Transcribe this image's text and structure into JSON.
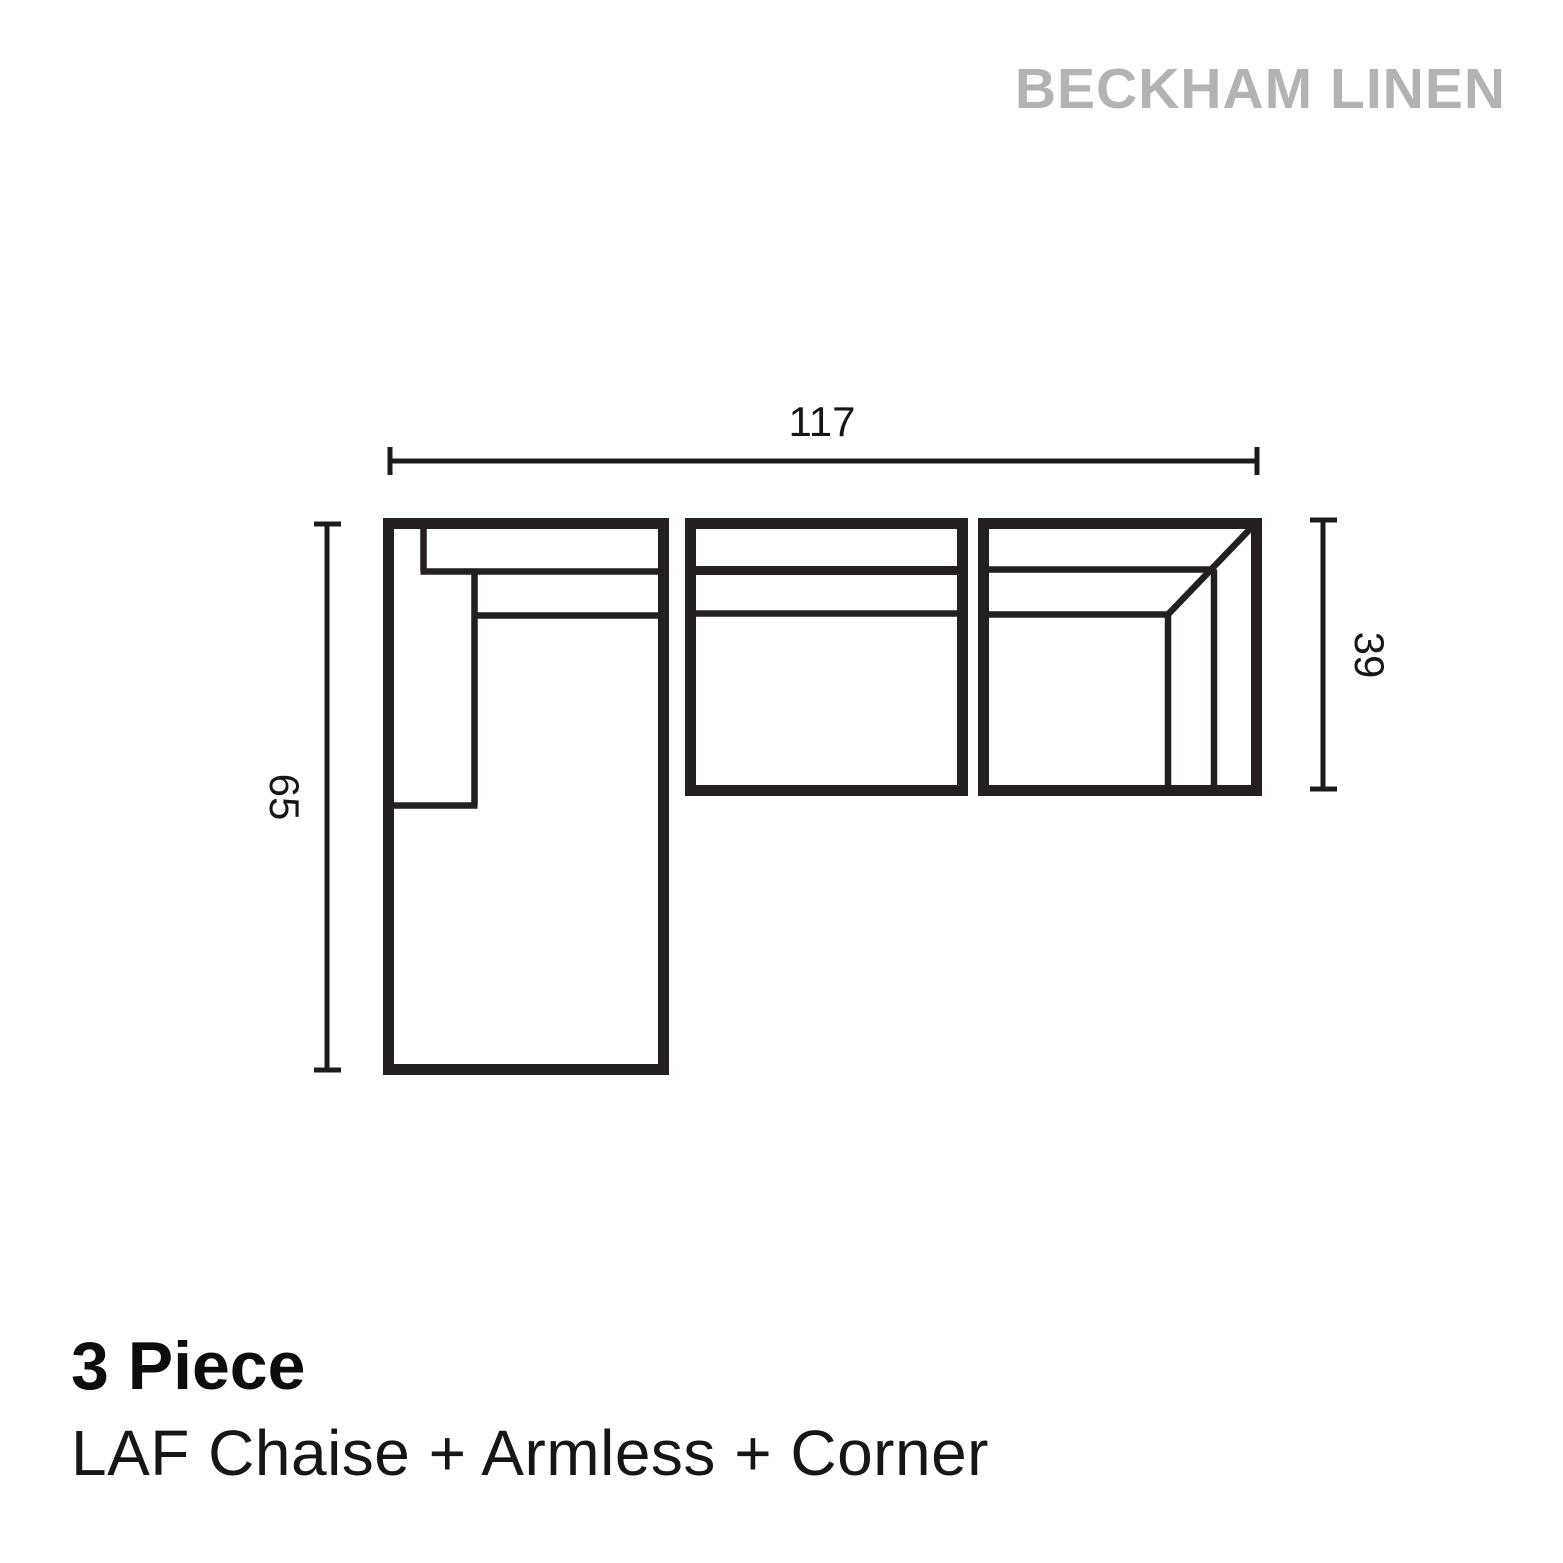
{
  "brand": "BECKHAM LINEN",
  "product": {
    "title": "3 Piece",
    "subtitle": "LAF Chaise + Armless + Corner"
  },
  "diagram": {
    "dimensions": {
      "overall_width": "117",
      "chaise_depth": "65",
      "corner_depth": "39"
    }
  },
  "colors": {
    "line": "#241f21",
    "brand_gray": "#b1b3b5",
    "text": "#0d0d0d",
    "background": "#ffffff"
  }
}
